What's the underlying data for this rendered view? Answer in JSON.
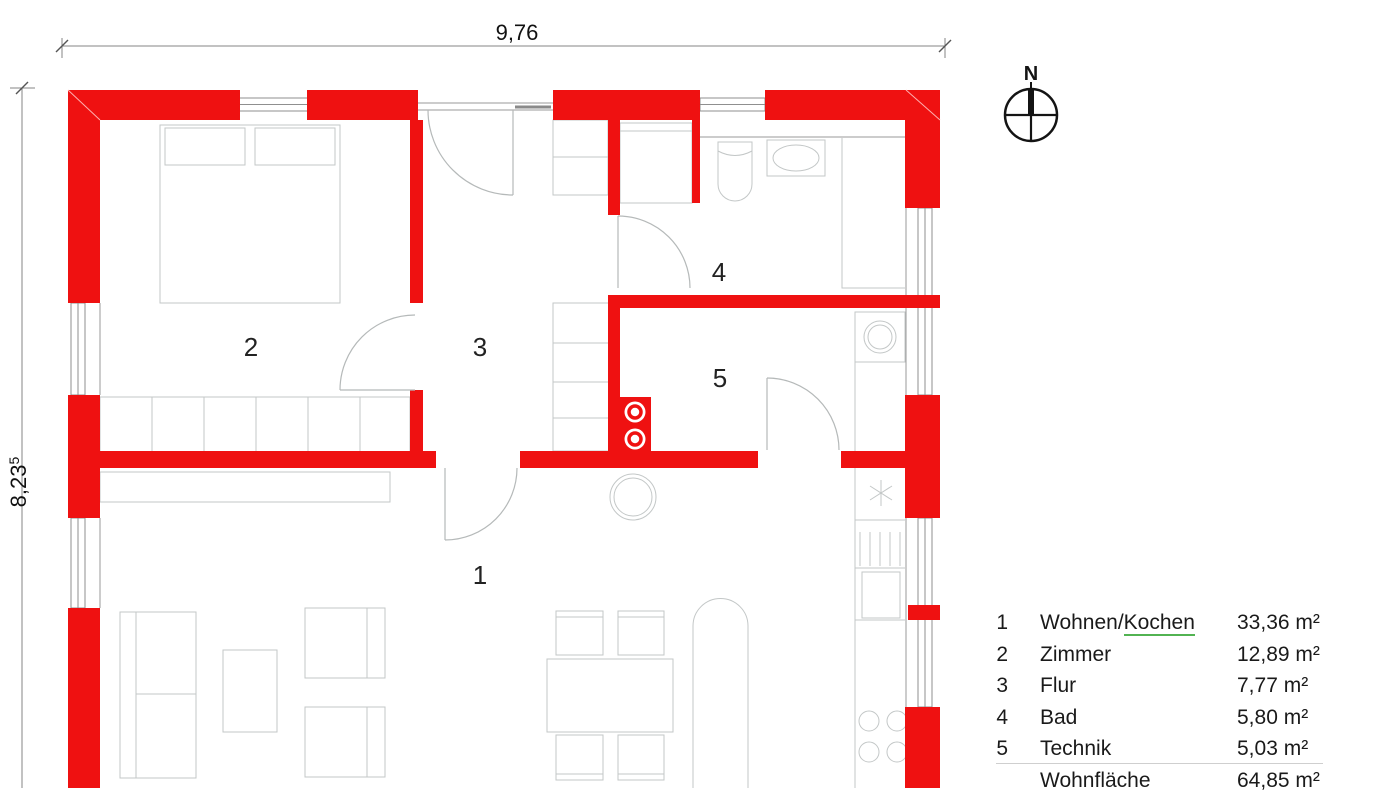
{
  "plan": {
    "dimension_width": {
      "value": "9,76"
    },
    "dimension_height": {
      "value": "8,23",
      "superscript": "5"
    },
    "compass": {
      "north_label": "N"
    }
  },
  "legend": {
    "rows": [
      {
        "no": "1",
        "name": "Wohnen/Kochen",
        "name_prefix": "Wohnen/",
        "name_underlined": "Kochen",
        "area": "33,36 m²"
      },
      {
        "no": "2",
        "name": "Zimmer",
        "area": "12,89 m²"
      },
      {
        "no": "3",
        "name": "Flur",
        "area": "7,77 m²"
      },
      {
        "no": "4",
        "name": "Bad",
        "area": "5,80 m²"
      },
      {
        "no": "5",
        "name": "Technik",
        "area": "5,03 m²"
      }
    ],
    "total": {
      "name": "Wohnfläche",
      "area": "64,85 m²"
    }
  },
  "colors": {
    "wall": "#ef1111",
    "spellcheck_underline": "#52b352",
    "text": "#1a1a1a"
  }
}
